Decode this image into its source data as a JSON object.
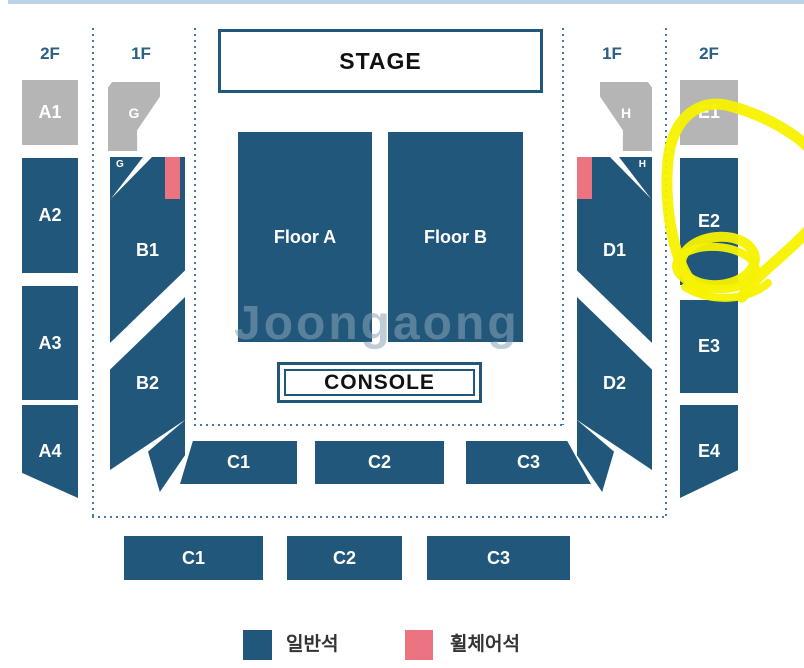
{
  "page_type": "concert-seat-map",
  "floor_labels": {
    "left_2f": "2F",
    "left_1f": "1F",
    "right_1f": "1F",
    "right_2f": "2F"
  },
  "stage": {
    "label": "STAGE"
  },
  "console": {
    "label": "CONSOLE"
  },
  "sections": {
    "a1": "A1",
    "a2": "A2",
    "a3": "A3",
    "a4": "A4",
    "g": "G",
    "g_mini": "G",
    "b1": "B1",
    "b2": "B2",
    "floor_a": "Floor A",
    "floor_b": "Floor B",
    "c1_upper": "C1",
    "c2_upper": "C2",
    "c3_upper": "C3",
    "c1_lower": "C1",
    "c2_lower": "C2",
    "c3_lower": "C3",
    "d1": "D1",
    "d2": "D2",
    "h": "H",
    "h_mini": "H",
    "e1": "E1",
    "e2": "E2",
    "e3": "E3",
    "e4": "E4"
  },
  "legend": {
    "general": {
      "label": "일반석",
      "color": "#20577B"
    },
    "wheelchair": {
      "label": "휠체어석",
      "color": "#EC7480"
    }
  },
  "watermark": {
    "text": "Joongaong"
  },
  "annotation": {
    "type": "hand-drawn-highlight",
    "shape": "large loop with small double circle",
    "highlighted_sections": [
      "E1",
      "E2"
    ],
    "color": "#F7F200"
  },
  "colors": {
    "seat_general": "#20577B",
    "seat_wheelchair": "#EC7480",
    "seat_2f_gray": "#B5B5B5",
    "dotted_line": "#4678A8",
    "floor_label_text": "#2A5F86",
    "top_strip": "#BAD3EA",
    "annotation_yellow": "#F7F200"
  }
}
